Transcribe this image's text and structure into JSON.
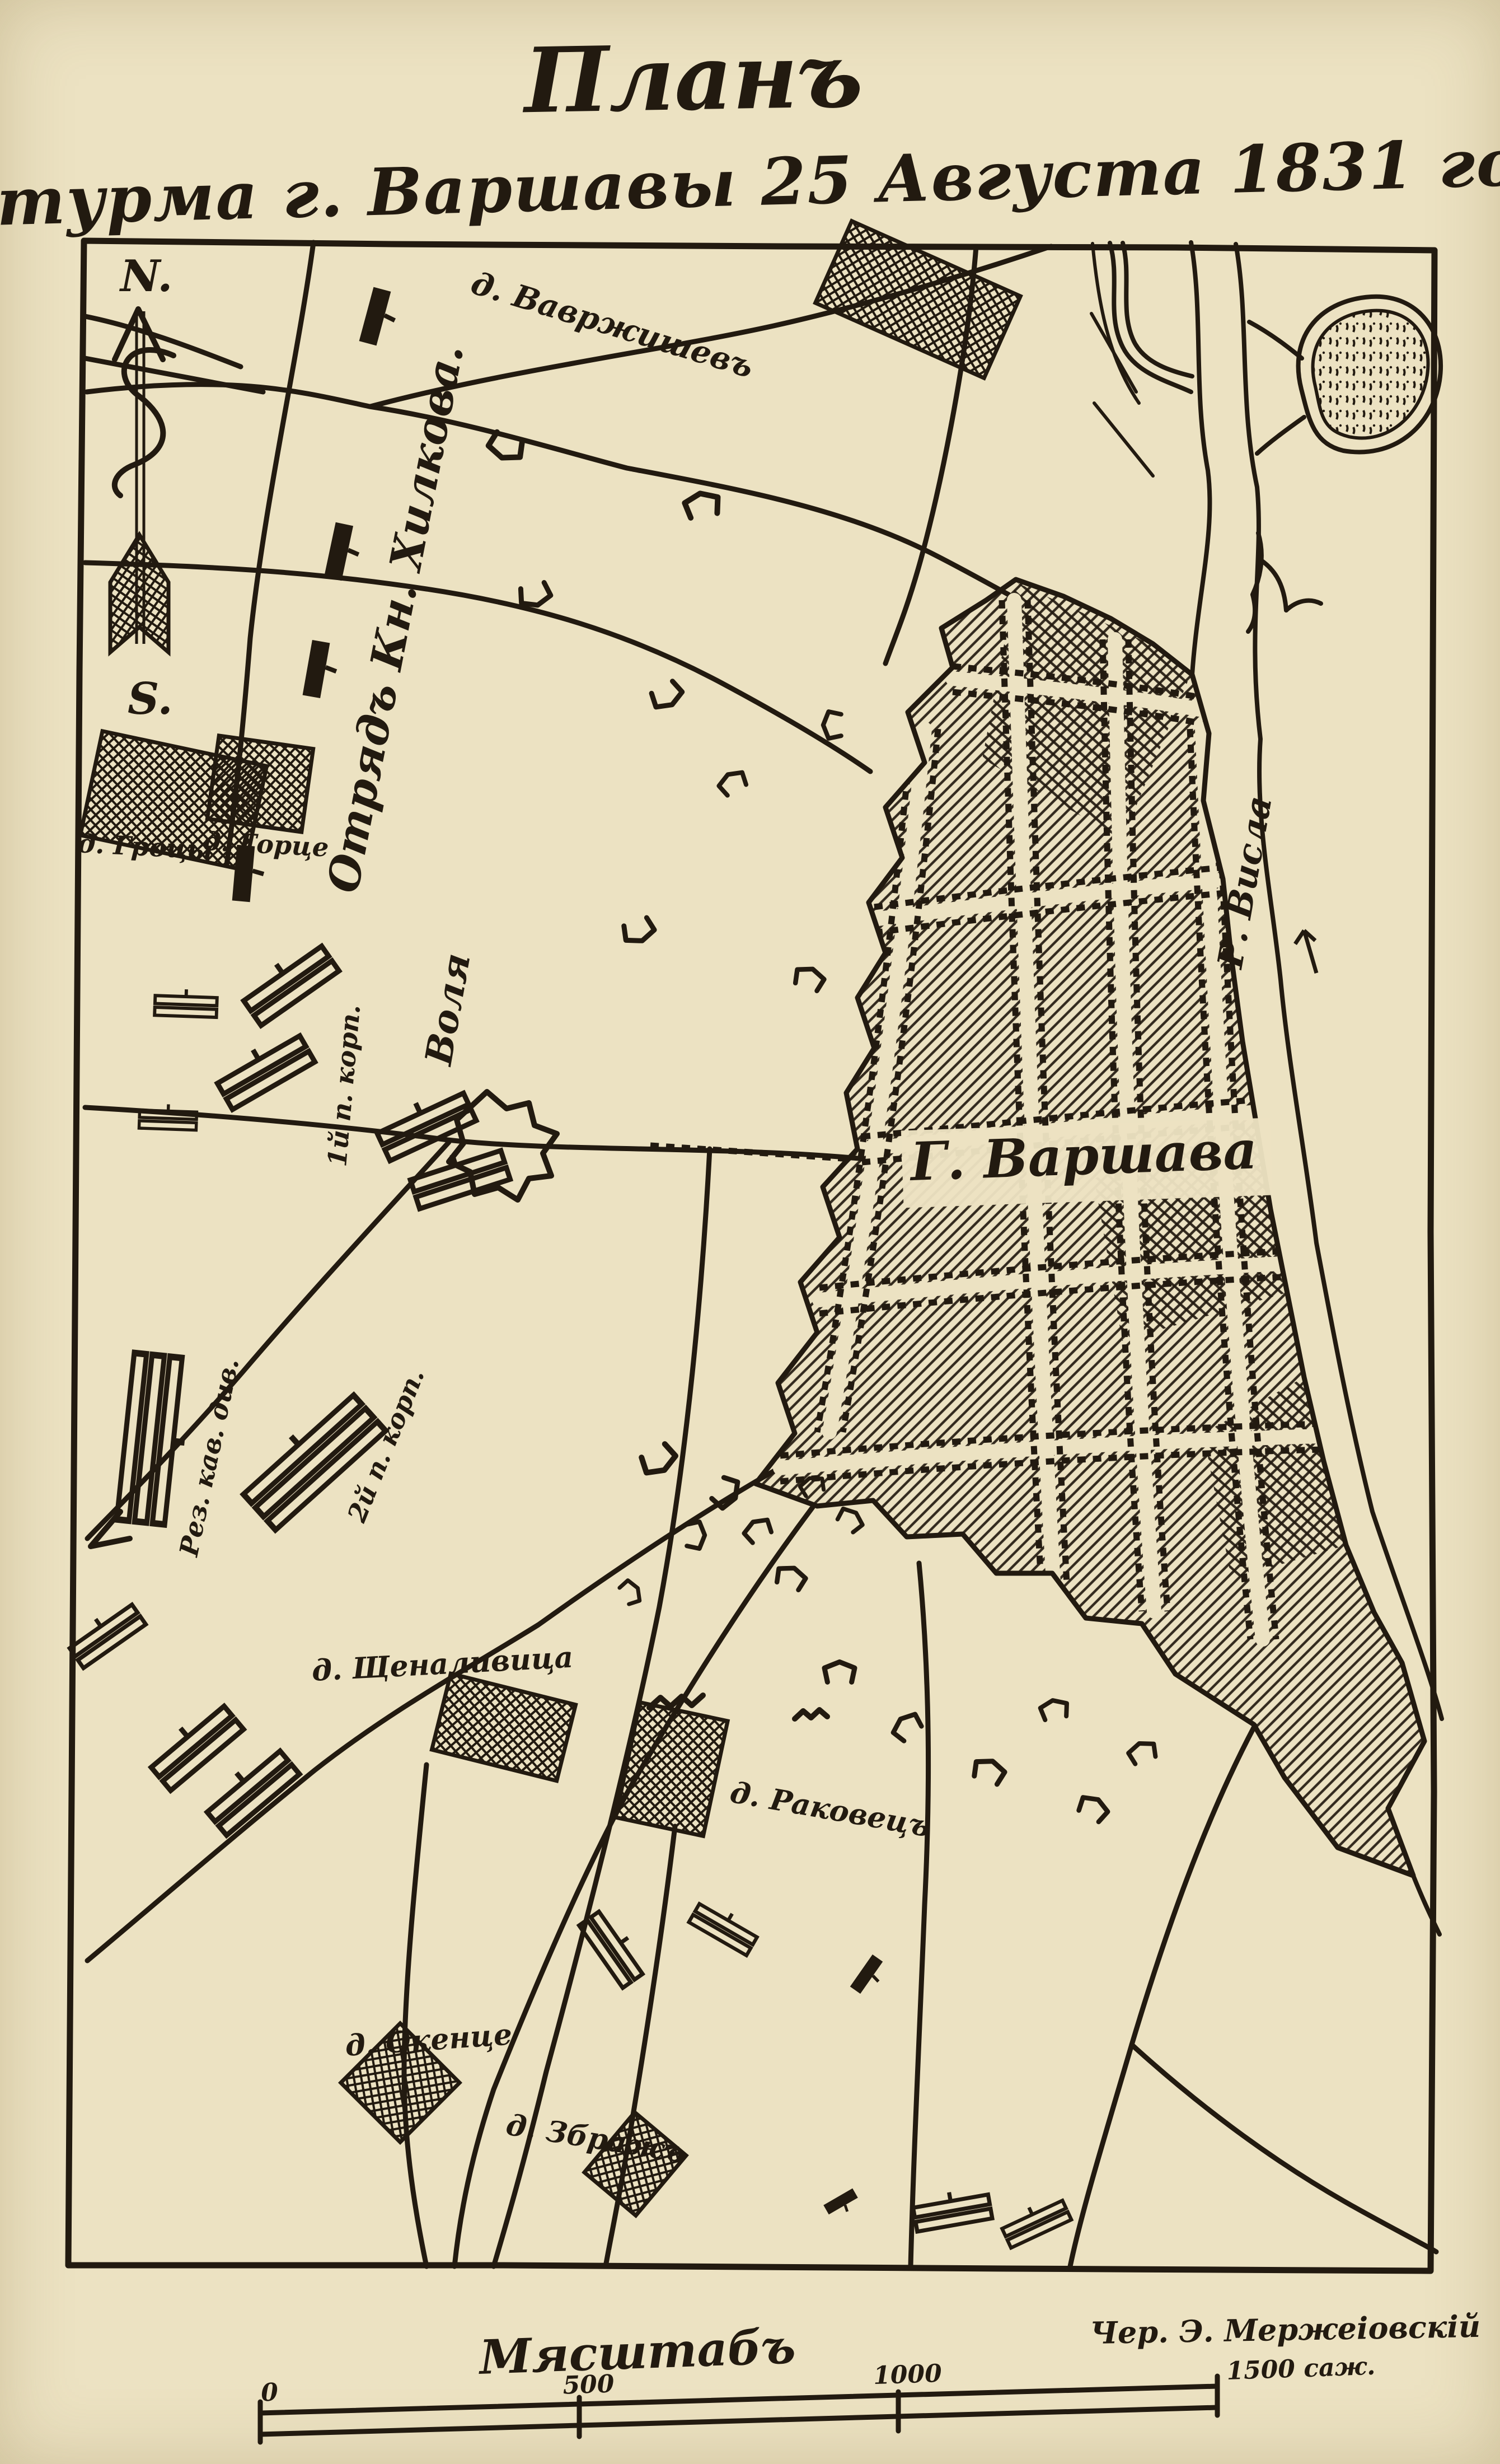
{
  "title": {
    "line1": "Планъ",
    "line2": "штурма г. Варшавы 25 Августа 1831 года."
  },
  "compass": {
    "north": "N.",
    "south": "S."
  },
  "map": {
    "city_label": "Г. Варшава",
    "river_label": "Р. Висла",
    "villages": {
      "bavrzhishav": "д. Вавржишевъ",
      "grotsy": "д. Гроцы",
      "gortse": "д. Горце",
      "volya": "Воля",
      "shchenalivitsa": "д. Щеналивица",
      "rakovets": "д. Раковецъ",
      "okentse": "д. Окенце",
      "zbrazh": "д. Збражъ"
    },
    "units": {
      "khilkov": "Отрядъ Кн. Хилкова.",
      "corps1": "1й п. корп.",
      "rez_kav": "Рез. кав. див.",
      "corps2": "2й п. корп."
    }
  },
  "scale": {
    "title": "Мясштабъ",
    "ticks": [
      "0",
      "500",
      "1000",
      "1500 саж."
    ]
  },
  "credit": "Чер. Э. Мержеіовскій",
  "colors": {
    "paper": "#ece2c2",
    "ink": "#221a10"
  }
}
